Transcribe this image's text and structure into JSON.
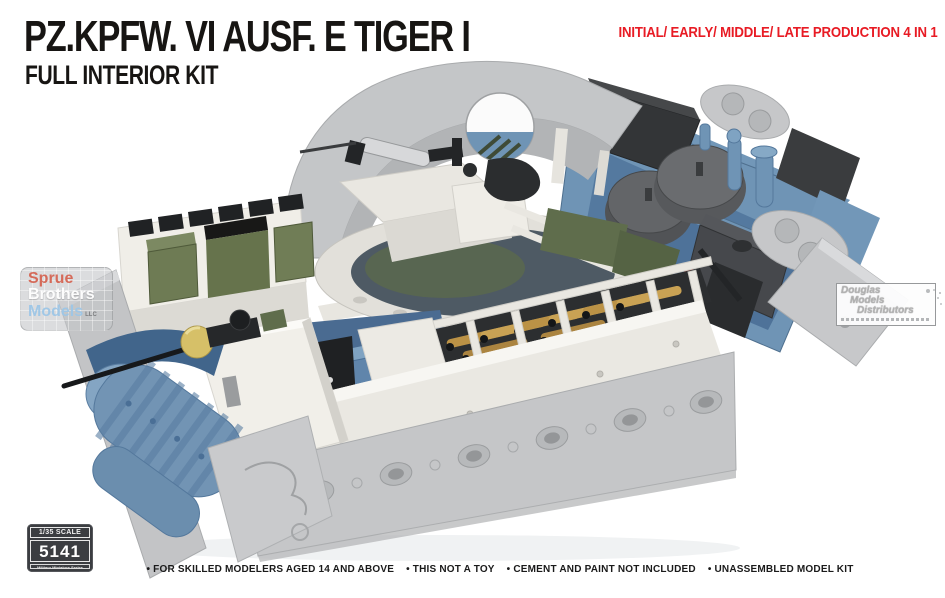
{
  "header": {
    "title": "PZ.KPFW. VI AUSF. E TIGER I",
    "subtitle": "FULL INTERIOR KIT",
    "production_note": "INITIAL/ EARLY/ MIDDLE/ LATE PRODUCTION 4 IN 1"
  },
  "watermarks": {
    "sprue_brothers": {
      "word1": "Sprue",
      "word2": "Brothers",
      "word3": "Models",
      "suffix": "LLC"
    },
    "douglas": {
      "word1": "Douglas",
      "word2": "Models",
      "word3": "Distributors"
    }
  },
  "badge": {
    "scale_label": "1/35 SCALE",
    "kit_number": "5141",
    "series_label": "Military Miniature Series"
  },
  "footer": {
    "items": [
      "• FOR SKILLED MODELERS AGED 14 AND ABOVE",
      "• THIS NOT A TOY",
      "• CEMENT AND PAINT NOT INCLUDED",
      "• UNASSEMBLED MODEL KIT"
    ]
  },
  "colors": {
    "title_black": "#171513",
    "accent_red": "#e81b24",
    "hull_gray": "#c5c6c8",
    "interior_ivory": "#eceae4",
    "interior_blue": "#6f94b5",
    "equipment_green": "#6e7b54",
    "ammo_brass": "#bb9246",
    "badge_bg": "#3b3d41"
  }
}
